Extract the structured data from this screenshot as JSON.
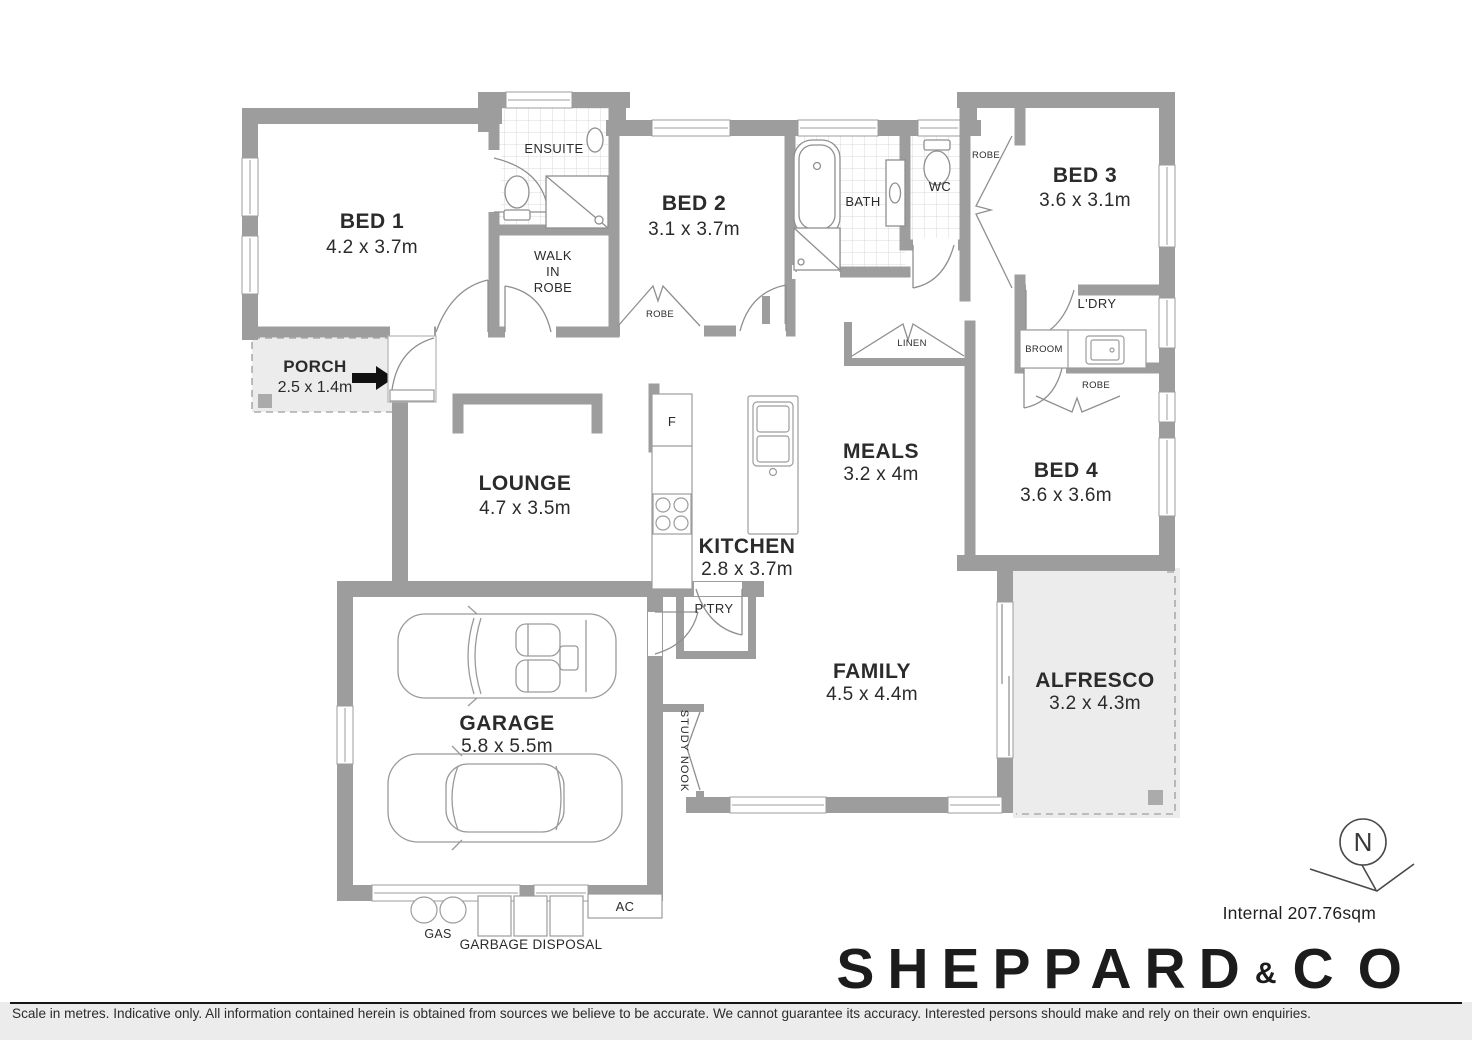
{
  "rooms": {
    "bed1": {
      "name": "BED 1",
      "dims": "4.2 x 3.7m"
    },
    "bed2": {
      "name": "BED 2",
      "dims": "3.1 x 3.7m"
    },
    "bed3": {
      "name": "BED 3",
      "dims": "3.6 x 3.1m"
    },
    "bed4": {
      "name": "BED 4",
      "dims": "3.6 x 3.6m"
    },
    "porch": {
      "name": "PORCH",
      "dims": "2.5 x 1.4m"
    },
    "lounge": {
      "name": "LOUNGE",
      "dims": "4.7 x 3.5m"
    },
    "kitchen": {
      "name": "KITCHEN",
      "dims": "2.8 x 3.7m"
    },
    "meals": {
      "name": "MEALS",
      "dims": "3.2 x 4m"
    },
    "family": {
      "name": "FAMILY",
      "dims": "4.5 x 4.4m"
    },
    "alfresco": {
      "name": "ALFRESCO",
      "dims": "3.2 x 4.3m"
    },
    "garage": {
      "name": "GARAGE",
      "dims": "5.8 x 5.5m"
    }
  },
  "labels": {
    "ensuite": "ENSUITE",
    "wir_line1": "WALK",
    "wir_line2": "IN",
    "wir_line3": "ROBE",
    "bath": "BATH",
    "wc": "WC",
    "robe_bed2": "ROBE",
    "robe_bed3": "ROBE",
    "robe_bed4": "ROBE",
    "linen": "LINEN",
    "ldry": "L'DRY",
    "broom": "BROOM",
    "ptry": "P'TRY",
    "study_nook": "STUDY NOOK",
    "fridge": "F",
    "ac": "AC",
    "gas": "GAS",
    "garbage": "GARBAGE DISPOSAL",
    "north": "N"
  },
  "footer": {
    "internal_area": "Internal 207.76sqm",
    "brand_word1": "SHEPPARD",
    "brand_amp": "&",
    "brand_word2": "CO",
    "disclaimer": "Scale in metres. Indicative only. All information contained herein is obtained from sources we believe to be accurate. We cannot guarantee its accuracy. Interested persons should make and rely on their own enquiries."
  },
  "colors": {
    "wall": "#9d9d9d",
    "light_fill": "#ececec",
    "line": "#8f8f8f",
    "accent_dark": "#111111"
  }
}
